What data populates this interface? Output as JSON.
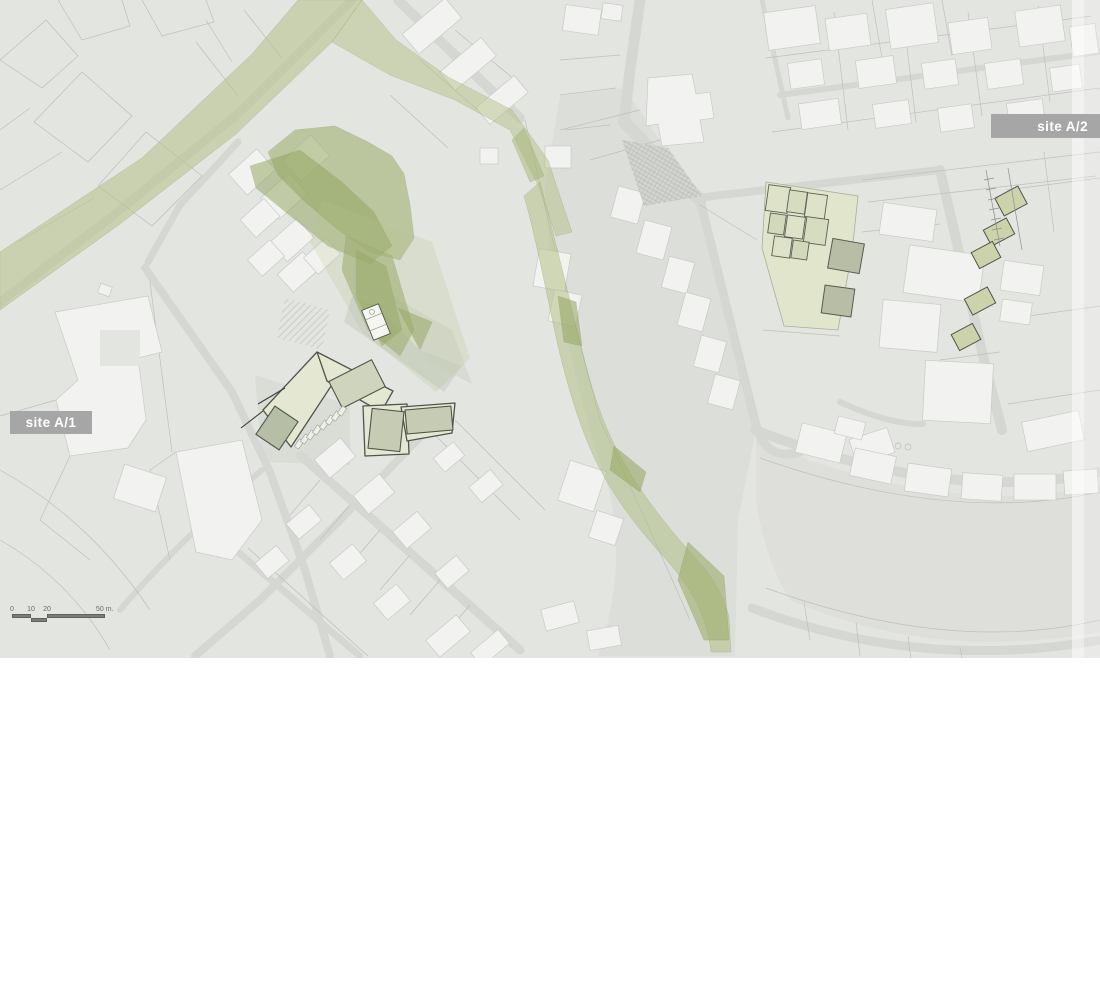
{
  "map": {
    "title": "urban site plan",
    "labels": {
      "site_a1": "site A/1",
      "site_a2": "site A/2"
    },
    "scale_bar": {
      "ticks": [
        "0",
        "10",
        "20",
        "50 m."
      ]
    },
    "colors": {
      "map_background": "#e3e5e1",
      "open_space": "#dcded9",
      "green_corridor": "#a3b372",
      "green_band": "#b6c28b",
      "site_parcel_fill": "#e4e8d3",
      "site_building_fill": "#c6ccb4",
      "site_outline": "#50544b",
      "building_fill": "#f2f3f0",
      "parcel_line": "#bcc0ba",
      "label_background": "#a6a6a6",
      "label_text": "#ffffff"
    }
  }
}
